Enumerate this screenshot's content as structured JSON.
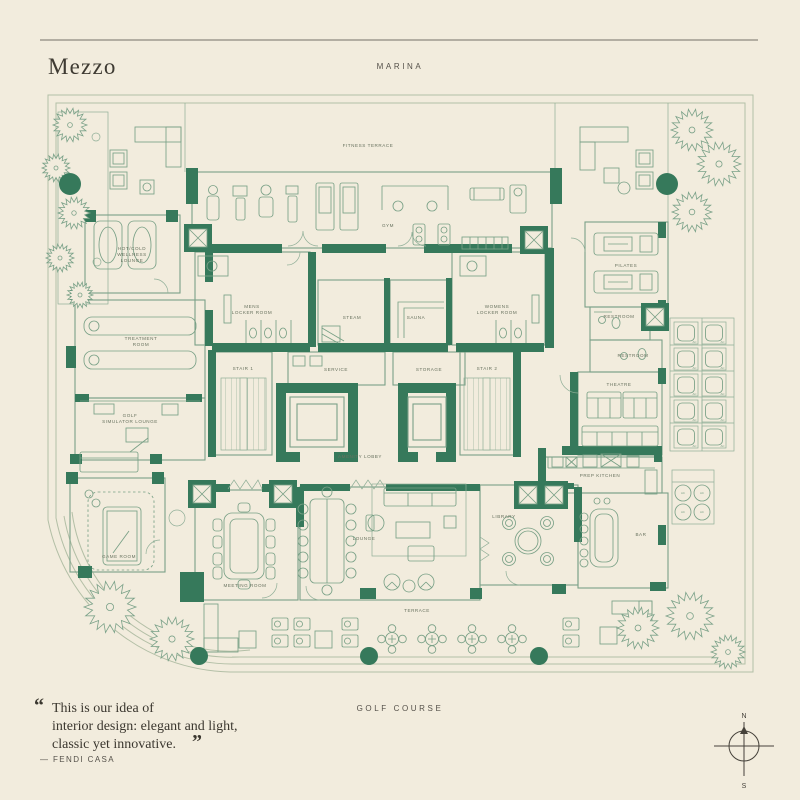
{
  "header": {
    "title": "Mezzo",
    "location_top": "MARINA"
  },
  "footer": {
    "quote_open": "“",
    "quote_close": "”",
    "quote_lines": [
      "This is our idea of",
      "interior design: elegant and light,",
      "classic yet innovative."
    ],
    "attribution": "— FENDI CASA",
    "location_bottom": "GOLF COURSE",
    "compass": {
      "north": "N",
      "south": "S"
    }
  },
  "plan": {
    "colors": {
      "background": "#f2ecdd",
      "wall": "#36795b",
      "line": "#7aa188",
      "label": "#68725f",
      "ink": "#3f3b33"
    },
    "ac_label": "AC",
    "labels": [
      {
        "lines": [
          "FITNESS TERRACE"
        ],
        "x": 368,
        "y": 147
      },
      {
        "lines": [
          "GYM"
        ],
        "x": 388,
        "y": 227
      },
      {
        "lines": [
          "HOT/COLD",
          "WELLNESS",
          "LOUNGE"
        ],
        "x": 132,
        "y": 250
      },
      {
        "lines": [
          "TREATMENT",
          "ROOM"
        ],
        "x": 141,
        "y": 340
      },
      {
        "lines": [
          "GOLF",
          "SIMULATOR LOUNGE"
        ],
        "x": 130,
        "y": 417
      },
      {
        "lines": [
          "MENS",
          "LOCKER ROOM"
        ],
        "x": 252,
        "y": 308
      },
      {
        "lines": [
          "STEAM"
        ],
        "x": 352,
        "y": 319
      },
      {
        "lines": [
          "SAUNA"
        ],
        "x": 416,
        "y": 319
      },
      {
        "lines": [
          "WOMENS",
          "LOCKER ROOM"
        ],
        "x": 497,
        "y": 308
      },
      {
        "lines": [
          "STAIR 1"
        ],
        "x": 243,
        "y": 370
      },
      {
        "lines": [
          "SERVICE"
        ],
        "x": 336,
        "y": 371
      },
      {
        "lines": [
          "STORAGE"
        ],
        "x": 429,
        "y": 371
      },
      {
        "lines": [
          "STAIR 2"
        ],
        "x": 487,
        "y": 370
      },
      {
        "lines": [
          "PILATES"
        ],
        "x": 626,
        "y": 267
      },
      {
        "lines": [
          "RESTROOM"
        ],
        "x": 619,
        "y": 318
      },
      {
        "lines": [
          "RESTROOM"
        ],
        "x": 633,
        "y": 357
      },
      {
        "lines": [
          "THEATRE"
        ],
        "x": 619,
        "y": 386
      },
      {
        "lines": [
          "PREP KITCHEN"
        ],
        "x": 600,
        "y": 477
      },
      {
        "lines": [
          "BAR"
        ],
        "x": 641,
        "y": 536
      },
      {
        "lines": [
          "LIBRARY"
        ],
        "x": 504,
        "y": 518
      },
      {
        "lines": [
          "LOUNGE"
        ],
        "x": 364,
        "y": 540
      },
      {
        "lines": [
          "MEETING ROOM"
        ],
        "x": 245,
        "y": 587
      },
      {
        "lines": [
          "GAME ROOM"
        ],
        "x": 119,
        "y": 558
      },
      {
        "lines": [
          "AMENITY LOBBY"
        ],
        "x": 360,
        "y": 458
      },
      {
        "lines": [
          "TERRACE"
        ],
        "x": 417,
        "y": 612
      }
    ],
    "trees": [
      {
        "x": 70,
        "y": 125,
        "r": 17
      },
      {
        "x": 56,
        "y": 168,
        "r": 14
      },
      {
        "x": 74,
        "y": 213,
        "r": 16
      },
      {
        "x": 60,
        "y": 258,
        "r": 14
      },
      {
        "x": 80,
        "y": 295,
        "r": 13
      },
      {
        "x": 692,
        "y": 130,
        "r": 21
      },
      {
        "x": 719,
        "y": 164,
        "r": 22
      },
      {
        "x": 692,
        "y": 212,
        "r": 20
      },
      {
        "x": 110,
        "y": 607,
        "r": 26
      },
      {
        "x": 172,
        "y": 639,
        "r": 22
      },
      {
        "x": 638,
        "y": 628,
        "r": 21
      },
      {
        "x": 690,
        "y": 616,
        "r": 24
      },
      {
        "x": 728,
        "y": 652,
        "r": 17
      }
    ],
    "planters": [
      {
        "x": 70,
        "y": 184,
        "r": 11
      },
      {
        "x": 667,
        "y": 184,
        "r": 11
      },
      {
        "x": 199,
        "y": 656,
        "r": 9
      },
      {
        "x": 369,
        "y": 656,
        "r": 9
      },
      {
        "x": 539,
        "y": 656,
        "r": 9
      }
    ],
    "ac_squares": [
      [
        674,
        322
      ],
      [
        702,
        322
      ],
      [
        674,
        348
      ],
      [
        702,
        348
      ],
      [
        674,
        374
      ],
      [
        702,
        374
      ],
      [
        674,
        400
      ],
      [
        702,
        400
      ],
      [
        674,
        426
      ],
      [
        702,
        426
      ]
    ],
    "ac_circles": [
      [
        683,
        493
      ],
      [
        702,
        493
      ],
      [
        683,
        512
      ],
      [
        702,
        512
      ]
    ]
  }
}
